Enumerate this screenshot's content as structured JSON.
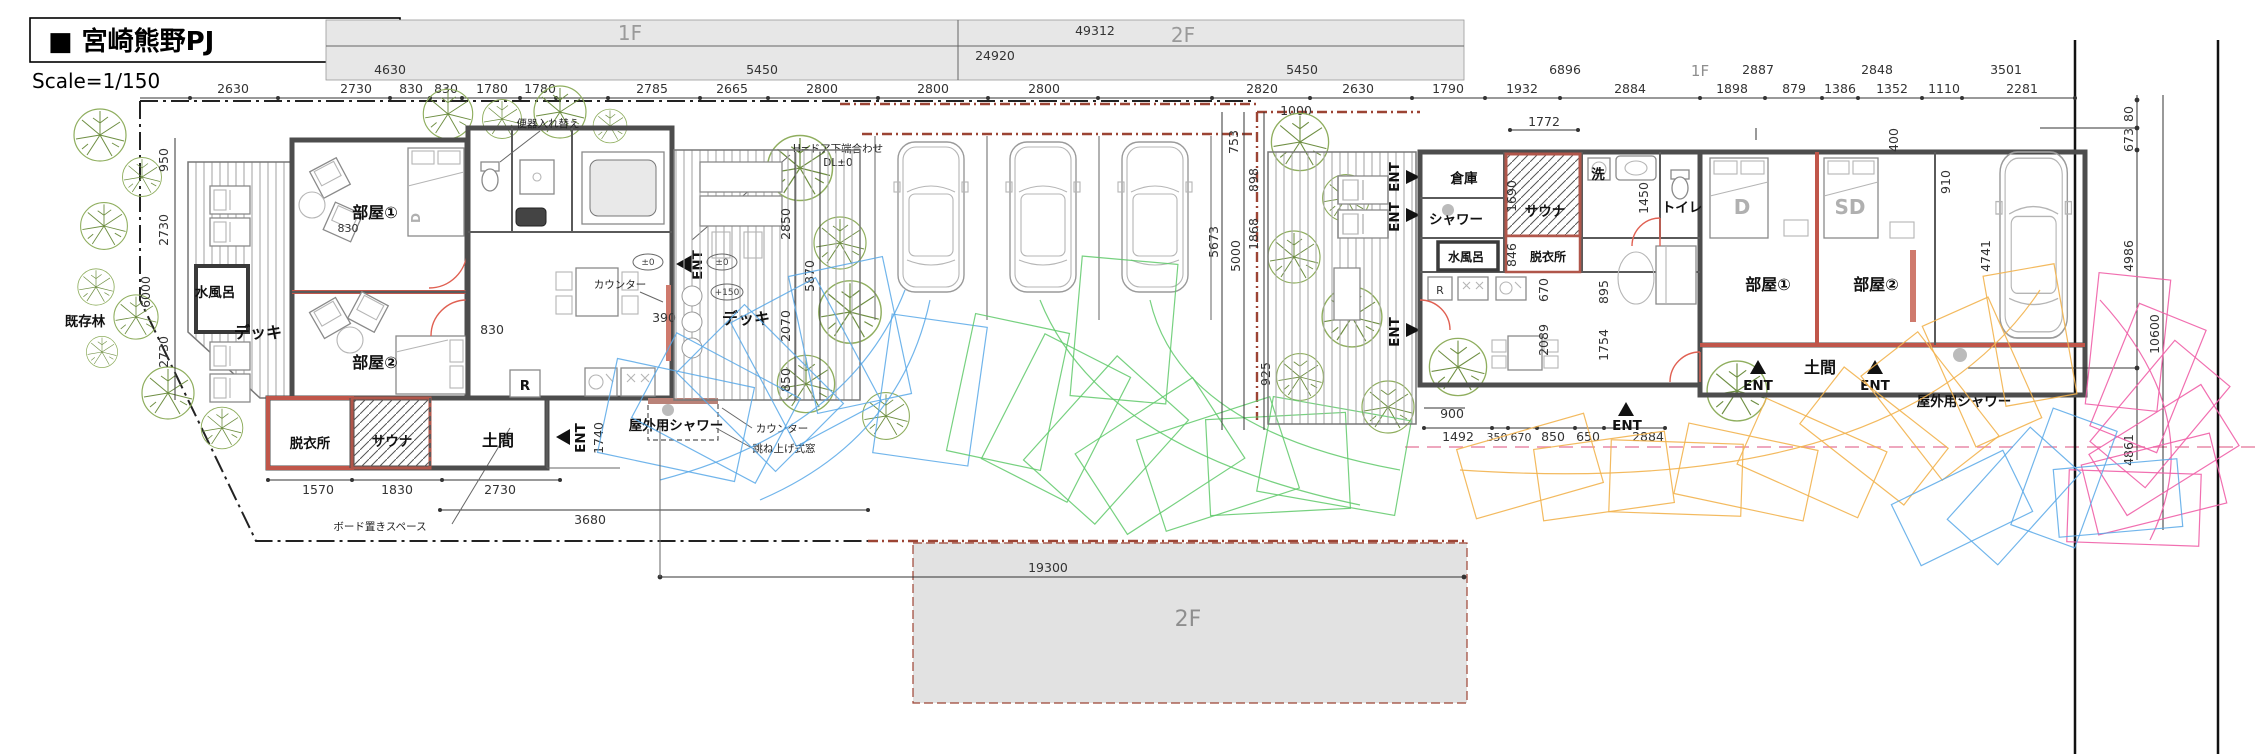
{
  "title": {
    "project": "■ 宮崎熊野PJ",
    "scale": "Scale=1/150"
  },
  "floors": {
    "f1_left": "1F",
    "f2_top": "2F",
    "f1_right": "1F",
    "f2_bottom": "2F"
  },
  "totals": {
    "t49312": "49312",
    "t24920": "24920",
    "t19300": "19300"
  },
  "spans": [
    "4630",
    "5450",
    "5450",
    "6896",
    "2887",
    "2848",
    "3501"
  ],
  "cells": [
    "2630",
    "2730",
    "830",
    "830",
    "1780",
    "1780",
    "2785",
    "2665",
    "2800",
    "2800",
    "2800",
    "2820",
    "2630",
    "1790",
    "1932",
    "2884",
    "1898",
    "879",
    "1386",
    "1352",
    "1110",
    "2281"
  ],
  "leftsite": {
    "forest": "既存林",
    "v": [
      "950",
      "2730",
      "6000",
      "2730"
    ],
    "bottom": [
      "1570",
      "1830",
      "2730",
      "3680"
    ],
    "board": "ボード置きスペース"
  },
  "leftbldg": {
    "room1": "部屋①",
    "room2": "部屋②",
    "bath": "水風呂",
    "deck": "デッキ",
    "dress": "脱衣所",
    "sauna": "サウナ",
    "doma": "土間",
    "ent": "ENT",
    "d1740": "1740",
    "d830gap": "830",
    "d830in": "830",
    "bedD": "D"
  },
  "midbldg": {
    "noteToilet": "便器入れ替え",
    "noteDoor": "H=ドア下端合わせ",
    "dl": "DL±0",
    "counter": "カウンター",
    "d390": "390",
    "deck": "デッキ",
    "fridge": "R",
    "ent": "ENT",
    "lv0a": "±0",
    "lv0b": "±0",
    "lv150": "+150",
    "v": [
      "2850",
      "5870",
      "2070",
      "850"
    ],
    "shower": "屋外用シャワー",
    "counter2": "カウンター",
    "window": "跳ね上げ式窓"
  },
  "midsite": {
    "d1000": "1000",
    "v": [
      "753",
      "898",
      "1868",
      "5673",
      "5000",
      "925"
    ]
  },
  "rightbldg": {
    "store": "倉庫",
    "shower": "シャワー",
    "bath": "水風呂",
    "sauna": "サウナ",
    "dress": "脱衣所",
    "wash": "洗",
    "toilet": "トイレ",
    "fridge": "R",
    "room1": "部屋①",
    "room2": "部屋②",
    "bedD": "D",
    "bedSD": "SD",
    "doma": "土間",
    "ent": "ENT",
    "d1772": "1772",
    "d1690": "1690",
    "d1450": "1450",
    "d846": "846",
    "d670": "670",
    "d895": "895",
    "d2089": "2089",
    "d1754": "1754",
    "d400": "400",
    "d910": "910",
    "d4741": "4741",
    "bottom": [
      "900",
      "1492",
      "350",
      "670",
      "850",
      "650",
      "2884"
    ],
    "shower2": "屋外用シャワー"
  },
  "rightsite": {
    "d80": "80",
    "d673": "673",
    "d4986": "4986",
    "d10600": "10600",
    "d4861": "4861"
  }
}
